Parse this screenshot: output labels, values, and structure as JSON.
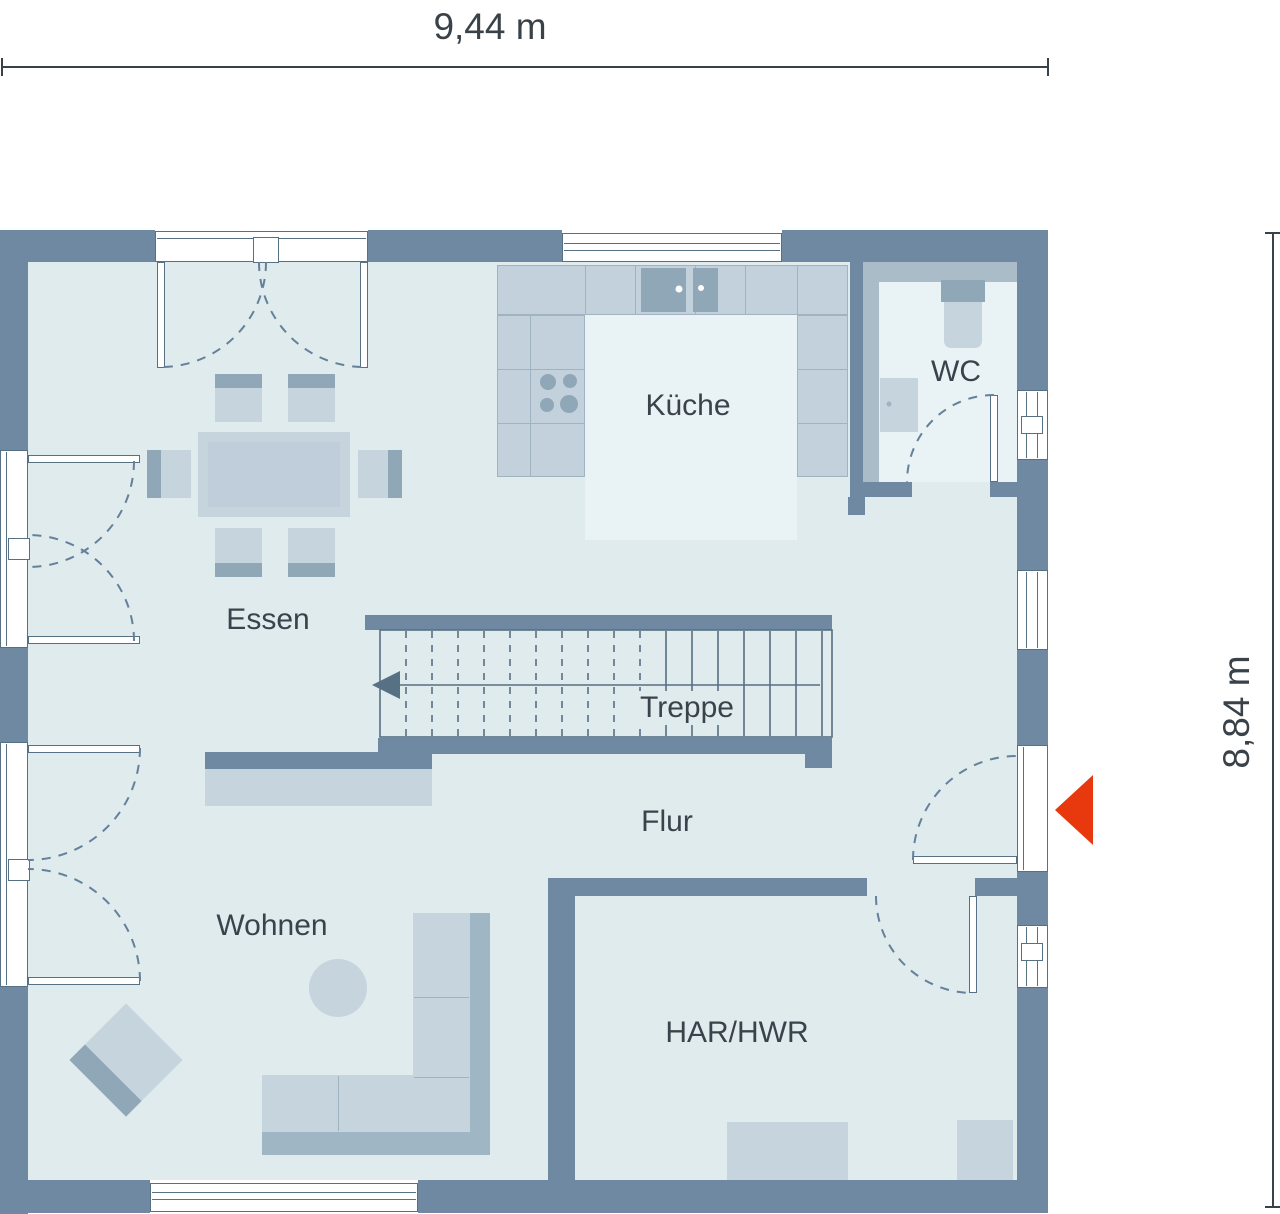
{
  "plan": {
    "type": "floor-plan",
    "dimensions": {
      "width_label": "9,44 m",
      "height_label": "8,84 m"
    },
    "rooms": [
      {
        "id": "essen",
        "label": "Essen"
      },
      {
        "id": "kueche",
        "label": "Küche"
      },
      {
        "id": "wc",
        "label": "WC"
      },
      {
        "id": "treppe",
        "label": "Treppe"
      },
      {
        "id": "flur",
        "label": "Flur"
      },
      {
        "id": "wohnen",
        "label": "Wohnen"
      },
      {
        "id": "har-hwr",
        "label": "HAR/HWR"
      }
    ],
    "entrance": {
      "icon": "entrance-arrow",
      "color": "#e8380e"
    }
  },
  "palette": {
    "wall": "#6e89a1",
    "floor": "#e0ebee",
    "floor_light": "#e9f2f4",
    "furniture": "#c6d4de",
    "furniture_inner": "#c0cedb",
    "counter": "#c3d1dc",
    "counter_stroke": "#9fb3c1",
    "fixture_dark": "#8fa7b7",
    "band": "#a9bcc7",
    "sofa_back": "#9fb6c4",
    "stroke": "#567084",
    "arc": "#64809a",
    "text": "#3a434b",
    "dim_line": "#3a4249",
    "accent_red": "#e8380e"
  }
}
